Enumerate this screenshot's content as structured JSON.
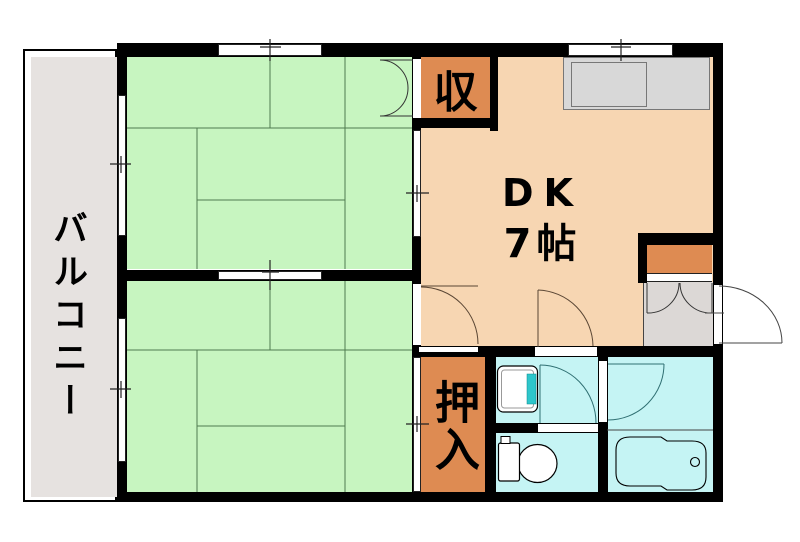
{
  "floorplan": {
    "balcony": {
      "label": "バルコニー"
    },
    "storage": {
      "label": "収"
    },
    "dining_kitchen": {
      "label": "DK",
      "size": "7帖"
    },
    "closet": {
      "label": "押入"
    },
    "colors": {
      "wall_black": "#000000",
      "tatami_green": "#C7F5C0",
      "tatami_grid": "#4F7B4F",
      "dk_peach": "#F7D6B2",
      "wet_area_cyan": "#C5F4F4",
      "accent_orange": "#DE8B52",
      "entrance_gray": "#DCD8D6",
      "balcony_gray": "#E6E2E0",
      "counter_gray": "#D8D8D8",
      "sink_teal": "#2EC6CB"
    },
    "fixtures": [
      "kitchen-counter",
      "kitchen-sink",
      "washbasin",
      "toilet",
      "bathtub",
      "shoe-cabinet"
    ],
    "openings": [
      "sliding-window",
      "sliding-door",
      "hinged-door",
      "storage-double-door",
      "entrance-door"
    ]
  }
}
